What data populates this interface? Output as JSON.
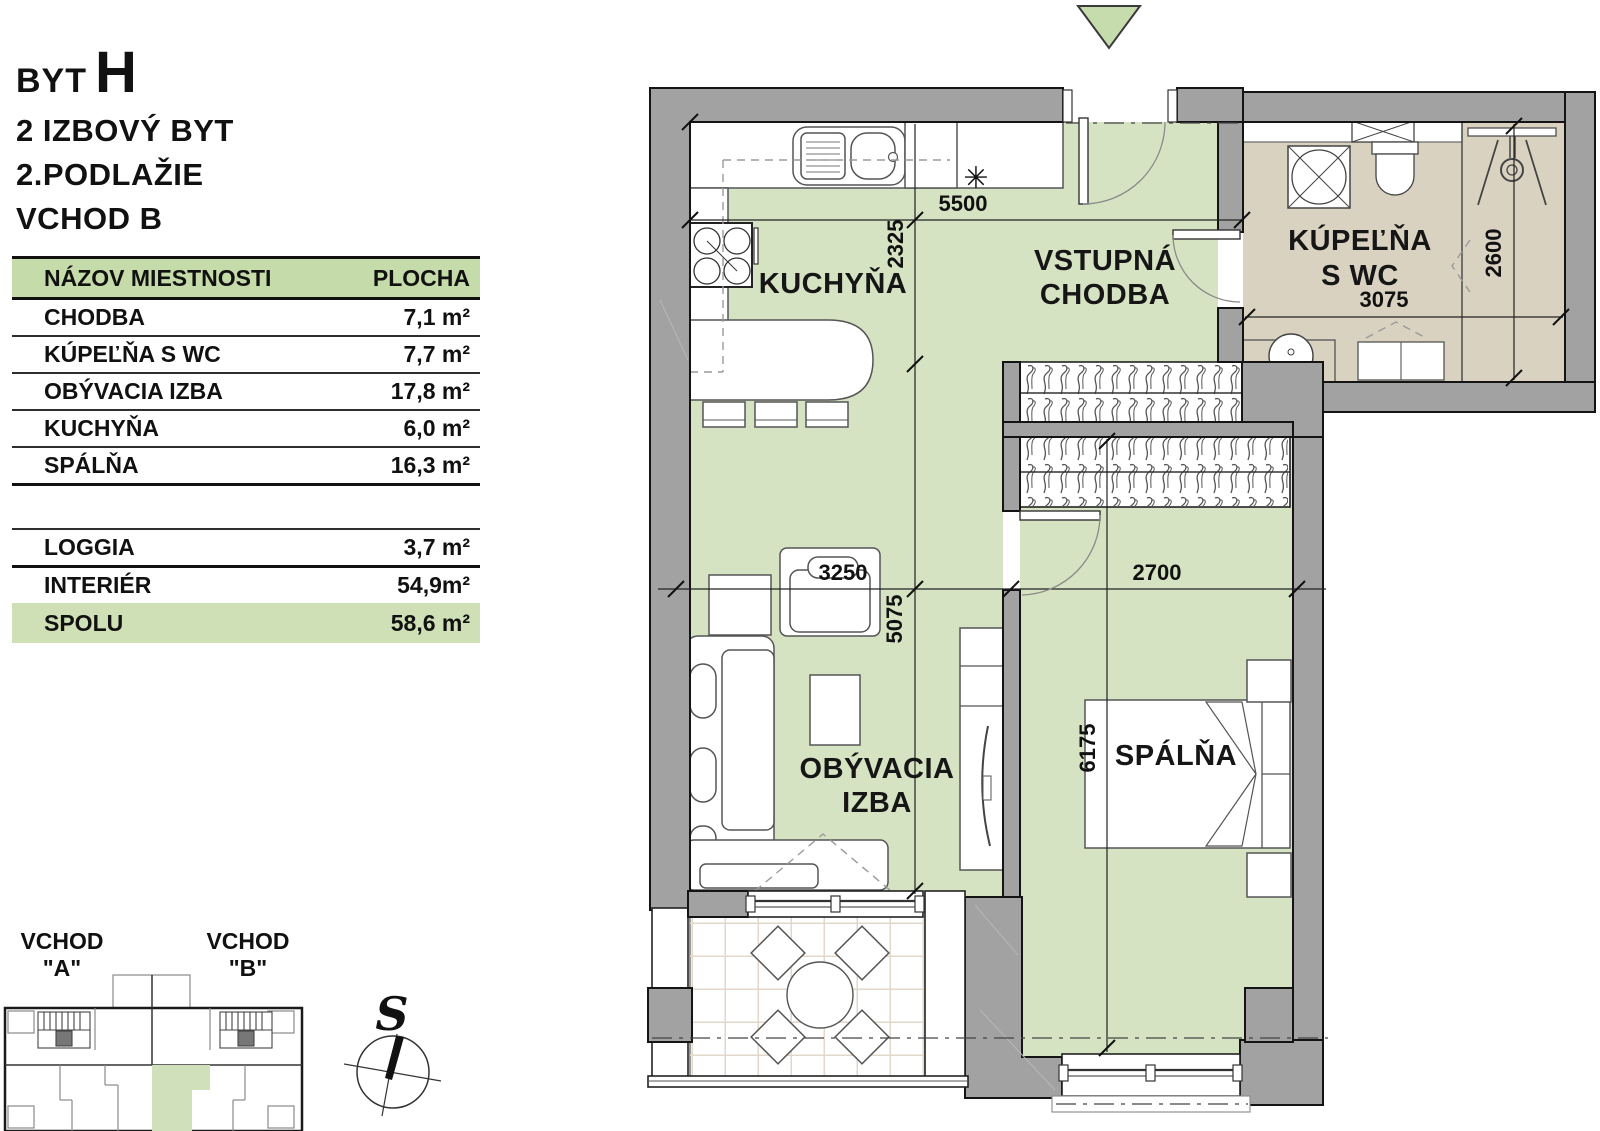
{
  "title": {
    "prefix": "BYT",
    "letter": "H",
    "lines": [
      "2 IZBOVÝ BYT",
      "2.PODLAŽIE",
      "VCHOD B"
    ]
  },
  "area_table": {
    "header": {
      "name_col": "NÁZOV MIESTNOSTI",
      "area_col": "PLOCHA"
    },
    "rooms": [
      {
        "name": "CHODBA",
        "area": "7,1 m²"
      },
      {
        "name": "KÚPEĽŇA S WC",
        "area": "7,7 m²"
      },
      {
        "name": "OBÝVACIA IZBA",
        "area": "17,8 m²"
      },
      {
        "name": "KUCHYŇA",
        "area": "6,0 m²"
      },
      {
        "name": "SPÁLŇA",
        "area": "16,3 m²"
      }
    ],
    "extras": [
      {
        "name": "LOGGIA",
        "area": "3,7 m²"
      },
      {
        "name": "INTERIÉR",
        "area": "54,9m²"
      }
    ],
    "total": {
      "name": "SPOLU",
      "area": "58,6 m²"
    }
  },
  "site_plan": {
    "entrance_a": [
      "VCHOD",
      "\"A\""
    ],
    "entrance_b": [
      "VCHOD",
      "\"B\""
    ],
    "compass": "S"
  },
  "floor_plan": {
    "rooms": {
      "kitchen": "KUCHYŇA",
      "hall_line1": "VSTUPNÁ",
      "hall_line2": "CHODBA",
      "bath_line1": "KÚPEĽŇA",
      "bath_line2": "S WC",
      "living_line1": "OBÝVACIA",
      "living_line2": "IZBA",
      "bedroom": "SPÁLŇA"
    },
    "dims": {
      "top_width": "5500",
      "kitchen_depth": "2325",
      "bath_width": "3075",
      "bath_height": "2600",
      "living_width": "3250",
      "living_height": "5075",
      "bedroom_width": "2700",
      "bedroom_height": "6175"
    },
    "symbols": {
      "appliance_marker": "✳"
    },
    "colors": {
      "floor_green": "#d5e3c3",
      "bath_floor": "#d9d2c1",
      "wall_gray": "#a2a2a2",
      "table_header_green": "#c6dbaa",
      "total_row_green": "#cfe0b6",
      "entry_triangle": "#c7dcad"
    }
  }
}
